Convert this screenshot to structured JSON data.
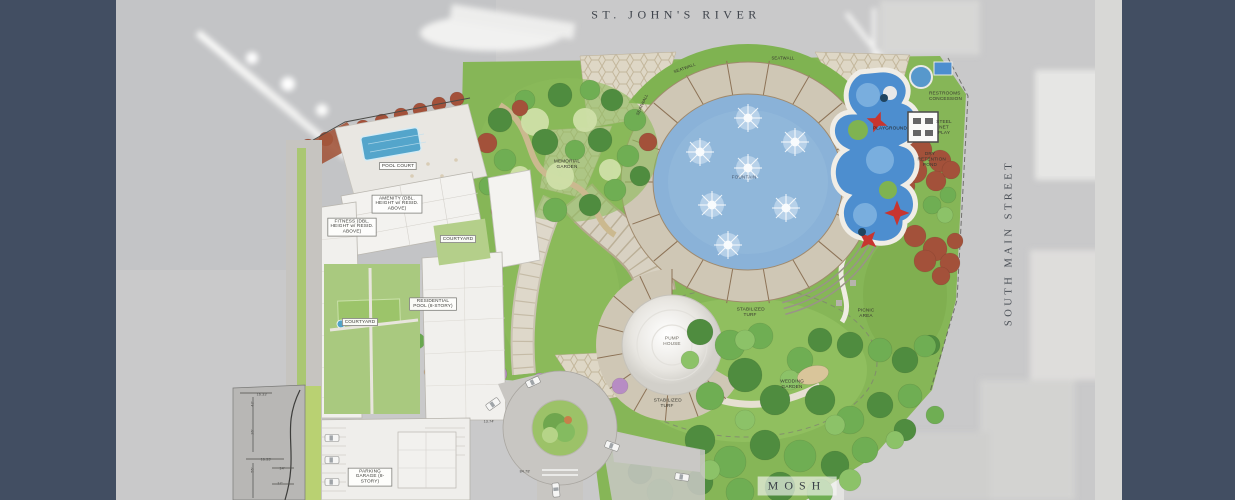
{
  "context": {
    "river": "ST. JOHN'S RIVER",
    "street": "SOUTH MAIN STREET",
    "museum": "MOSH"
  },
  "site": {
    "boxed_labels": {
      "pool_court": "POOL COURT",
      "amenity": "AMENITY (DBL. HEIGHT w/ RESID. ABOVE)",
      "fitness": "FITNESS (DBL. HEIGHT w/ RESID. ABOVE)",
      "courtyard_upper": "COURTYARD",
      "residential_pool": "RESIDENTIAL POOL (8-STORY)",
      "courtyard_lower": "COURTYARD",
      "parking_garage": "PARKING GARAGE (8-STORY)"
    },
    "feature_labels": {
      "memorial_garden": "MEMORIAL GARDEN",
      "fountain": "FOUNTAIN",
      "seatwall_nw": "SEATWALL",
      "seatwall_ne": "SEATWALL",
      "seatwall_w": "SEATWALL",
      "playground": "PLAYGROUND",
      "restrooms": "RESTROOMS CONCESSION",
      "net_play": "STEEL NET PLAY",
      "dry_pond": "DRY RETENTION POND",
      "picnic": "PICNIC AREA",
      "wedding": "WEDDING GARDEN",
      "turf_east": "STABILIZED TURF",
      "turf_south": "STABILIZED TURF",
      "pump_house": "PUMP HOUSE"
    },
    "dimensions": {
      "d1": "16.33'",
      "d2": "42'",
      "d3": "26'",
      "d4": "16.33'",
      "d5": "55'",
      "d6": "14'",
      "d7": "17'",
      "d8": "13.74'",
      "d9": "84.78'"
    },
    "watermark": "HALFF",
    "colors": {
      "frame_bars": "#424e62",
      "lawn": "#86b657",
      "fountain_water": "#8ab2d8",
      "playground_surface": "#4d8ecf",
      "pavers": "#d6cfc0",
      "russet_trees": "#a3513a"
    }
  }
}
